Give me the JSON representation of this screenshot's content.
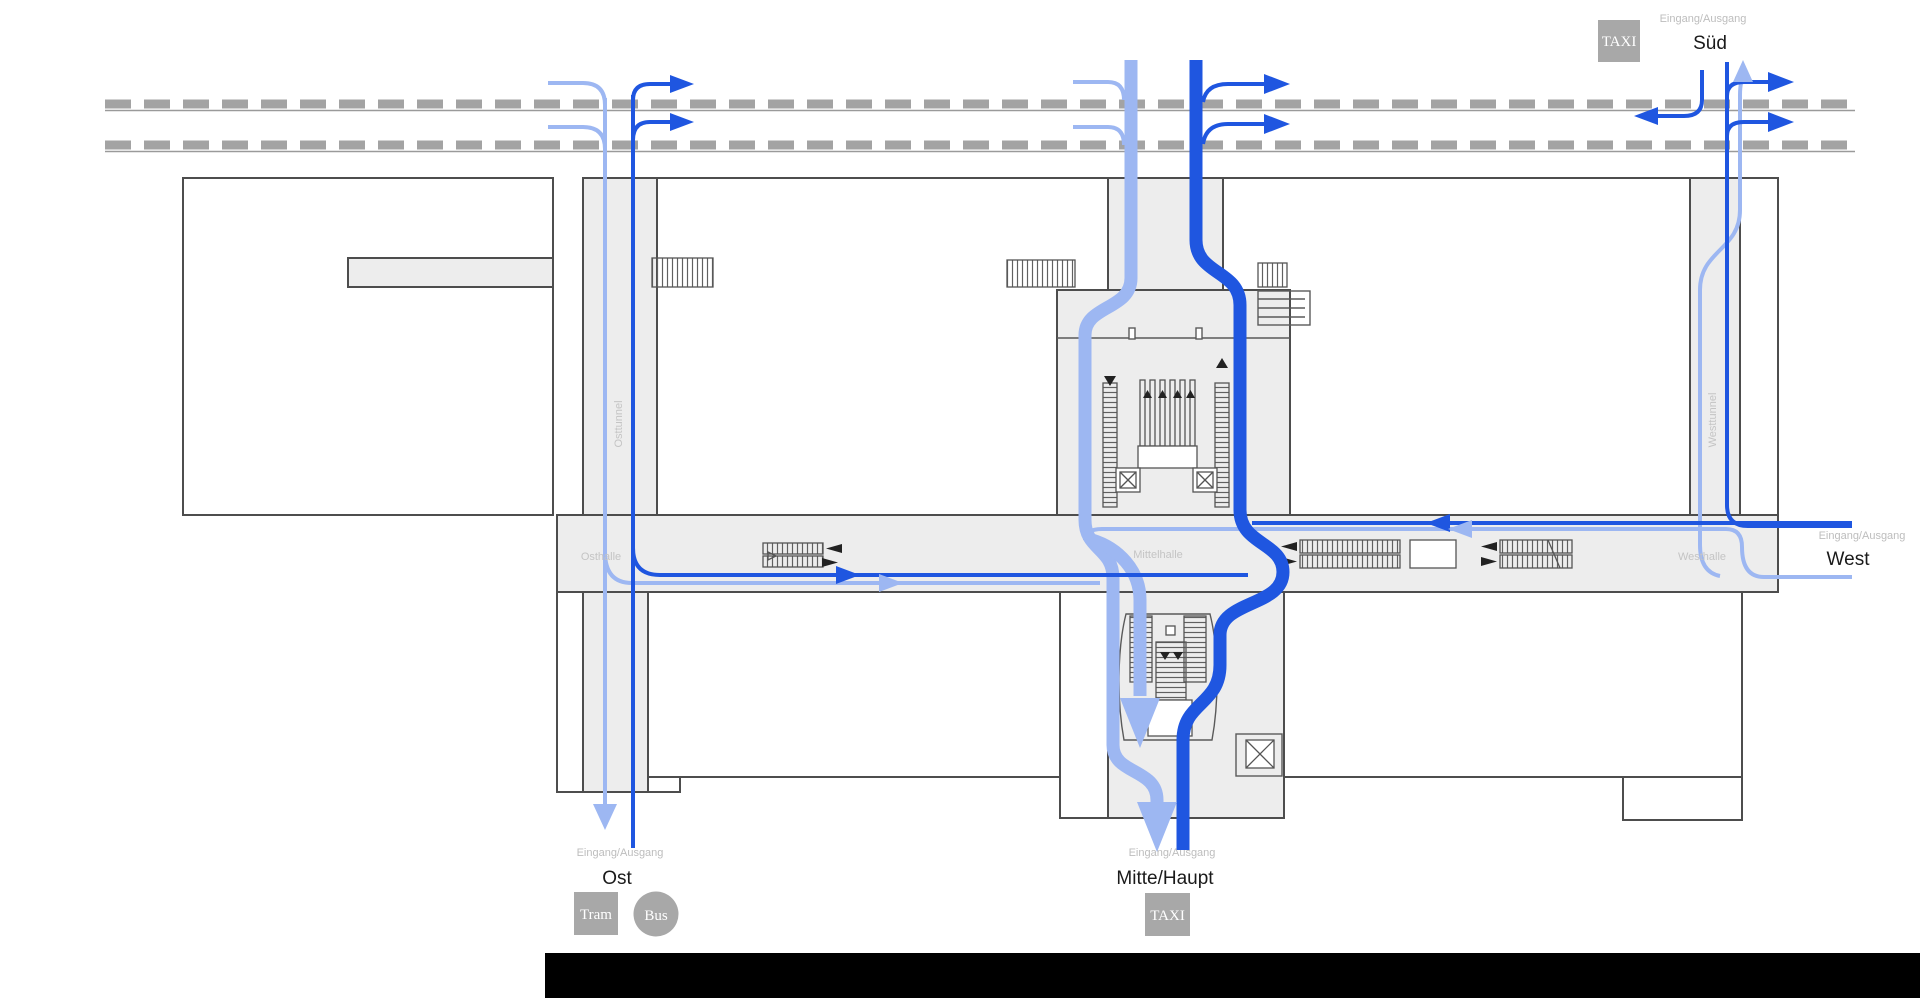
{
  "diagram_type": "station-floor-plan",
  "colors": {
    "flow_dark": "#1f56e0",
    "flow_light": "#9db7f2",
    "building_fill": "#ededed",
    "outline": "#4d4d4d",
    "track": "#a3a3a3",
    "badge_gray": "#a8a8a8",
    "label_gray": "#bdbdbd",
    "text_dark": "#1a1a1a"
  },
  "entrances": {
    "sued": {
      "type_label": "Eingang/Ausgang",
      "name": "Süd"
    },
    "west": {
      "type_label": "Eingang/Ausgang",
      "name": "West"
    },
    "ost": {
      "type_label": "Eingang/Ausgang",
      "name": "Ost"
    },
    "mitte_haupt": {
      "type_label": "Eingang/Ausgang",
      "name": "Mitte/Haupt"
    }
  },
  "badges": {
    "taxi_sued": "TAXI",
    "taxi_mitte": "TAXI",
    "tram": "Tram",
    "bus": "Bus"
  },
  "halls": {
    "osthalle": "Osthalle",
    "mittelhalle": "Mittelhalle",
    "westhalle": "Westhalle"
  },
  "tunnels": {
    "osttunnel": "Osttunnel",
    "westtunnel": "Westtunnel"
  }
}
